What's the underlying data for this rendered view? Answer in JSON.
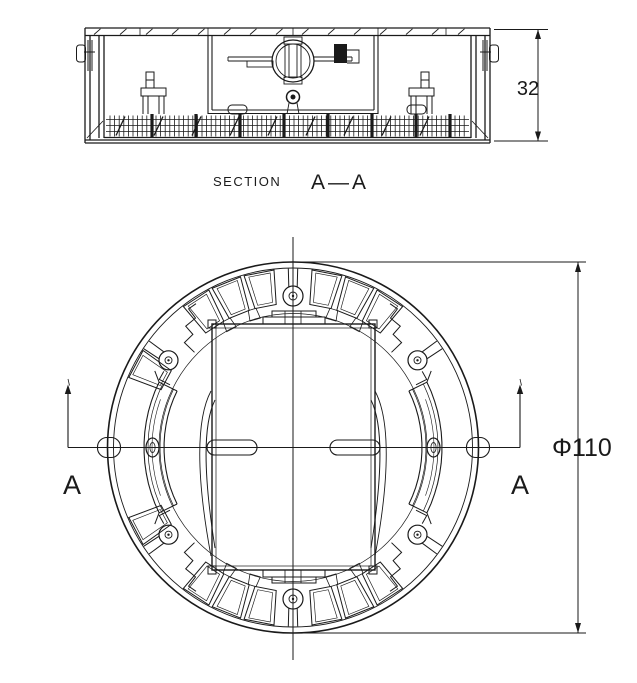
{
  "drawing": {
    "section_label": "SECTION",
    "section_cut": "A—A",
    "height_dim": "32",
    "diameter_dim": "Φ110",
    "cut_marker_left": "A",
    "cut_marker_right": "A"
  },
  "colors": {
    "ink": "#1a1a1a",
    "background": "#ffffff"
  }
}
